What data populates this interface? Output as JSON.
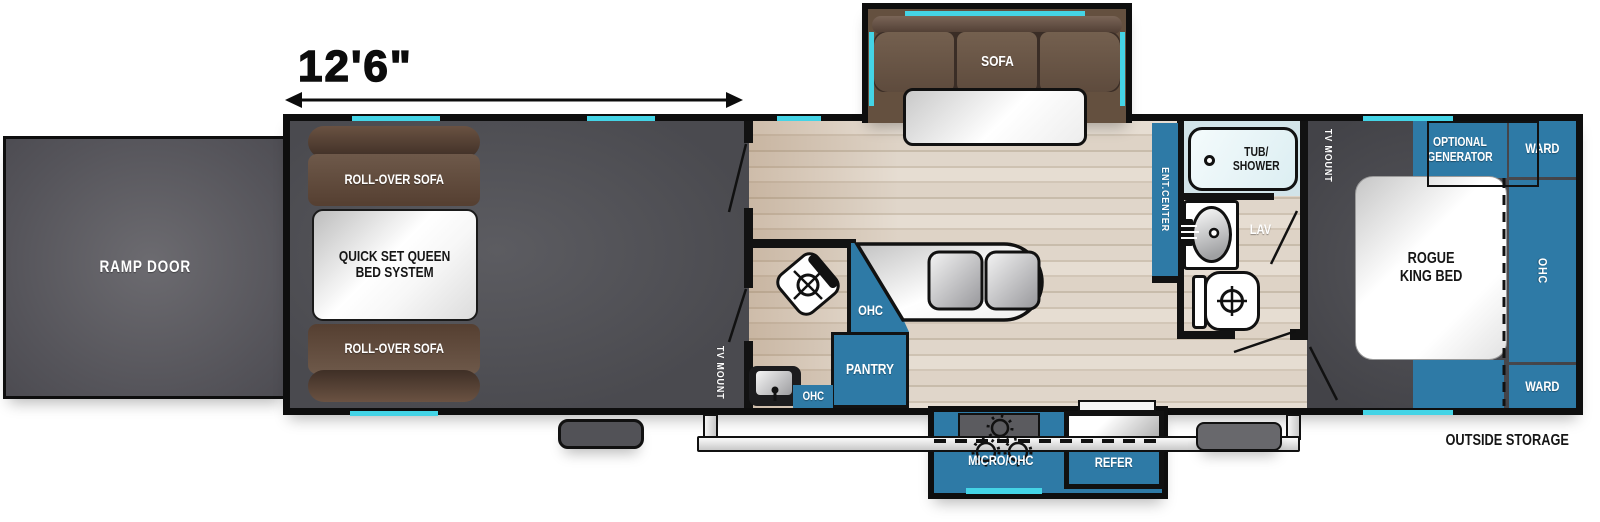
{
  "floorplan": {
    "dimension": "12'6\"",
    "outside_storage": "OUTSIDE STORAGE",
    "ramp_door": "RAMP DOOR",
    "garage": {
      "roll_over_sofa_top": "ROLL-OVER SOFA",
      "queen_bed": "QUICK SET QUEEN\nBED SYSTEM",
      "roll_over_sofa_bottom": "ROLL-OVER SOFA",
      "tv_mount": "TV MOUNT"
    },
    "living": {
      "sofa": "SOFA",
      "ohc": "OHC",
      "pantry": "PANTRY"
    },
    "half_bath": {
      "ohc": "OHC"
    },
    "bath": {
      "ent_center": "ENT.CENTER",
      "tub_shower": "TUB/\nSHOWER",
      "lav": "LAV"
    },
    "bedroom": {
      "tv_mount": "TV MOUNT",
      "optional_generator": "OPTIONAL\nGENERATOR",
      "ward_top": "WARD",
      "ohc": "OHC",
      "ward_bottom": "WARD",
      "bed": "ROGUE\nKING BED"
    },
    "exterior_kitchen": {
      "micro_ohc": "MICRO/OHC",
      "refer": "REFER"
    },
    "colors": {
      "cabinet_teal": "#2e7aa6",
      "accent_cyan": "#44d4e6",
      "sofa_brown": "#6b564a",
      "dark_floor": "#4a4a4f",
      "wood_floor": "#ddd2c5"
    }
  }
}
